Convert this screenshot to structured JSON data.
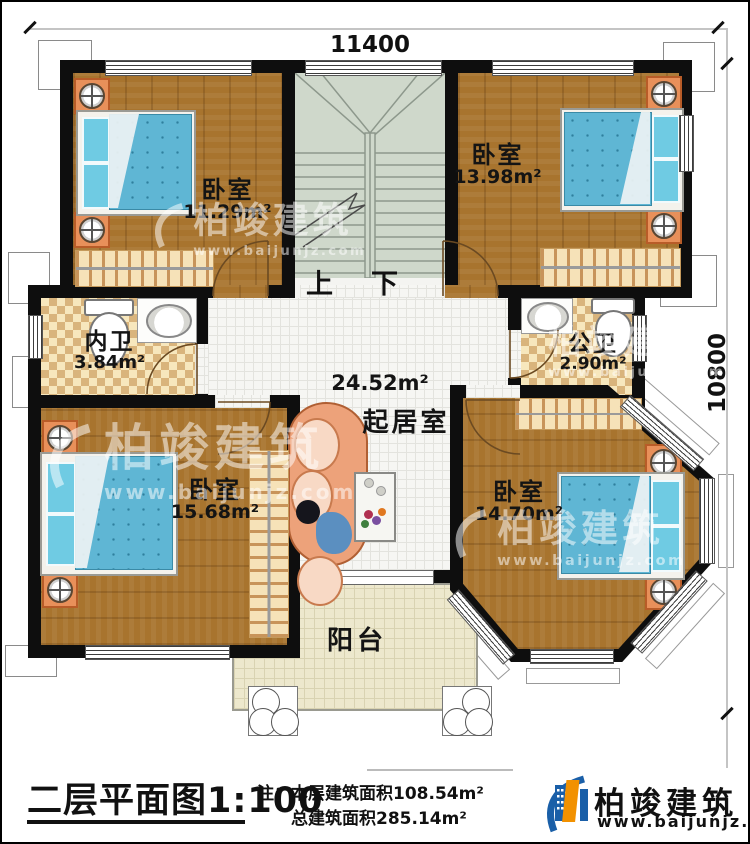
{
  "dimensions": {
    "width_label": "11400",
    "height_label": "10800"
  },
  "stairs": {
    "up": "上",
    "down": "下"
  },
  "rooms": {
    "bedroom_tl": {
      "name": "卧室",
      "area": "11.29m²"
    },
    "bedroom_tr": {
      "name": "卧室",
      "area": "13.98m²"
    },
    "bath_inner": {
      "name": "内卫",
      "area": "3.84m²"
    },
    "bath_public": {
      "name": "公卫",
      "area": "2.90m²"
    },
    "living": {
      "name": "起居室",
      "area": "24.52m²"
    },
    "bedroom_bl": {
      "name": "卧室",
      "area": "15.68m²"
    },
    "bedroom_br": {
      "name": "卧室",
      "area": "14.70m²"
    },
    "balcony": {
      "name": "阳台"
    }
  },
  "watermark": {
    "brand": "柏竣建筑",
    "website": "www.baijunjz.com"
  },
  "footer": {
    "title": "二层平面图",
    "scale": "1:100",
    "note_label": "注：",
    "note_line1": "本层建筑面积108.54m²",
    "note_line2": "总建筑面积285.14m²",
    "brand": "柏竣建筑",
    "website": "www.baijunjz.com"
  },
  "colors": {
    "wall": "#0e0e0e",
    "brand_blue": "#1a5fa8",
    "brand_orange": "#f29100"
  }
}
